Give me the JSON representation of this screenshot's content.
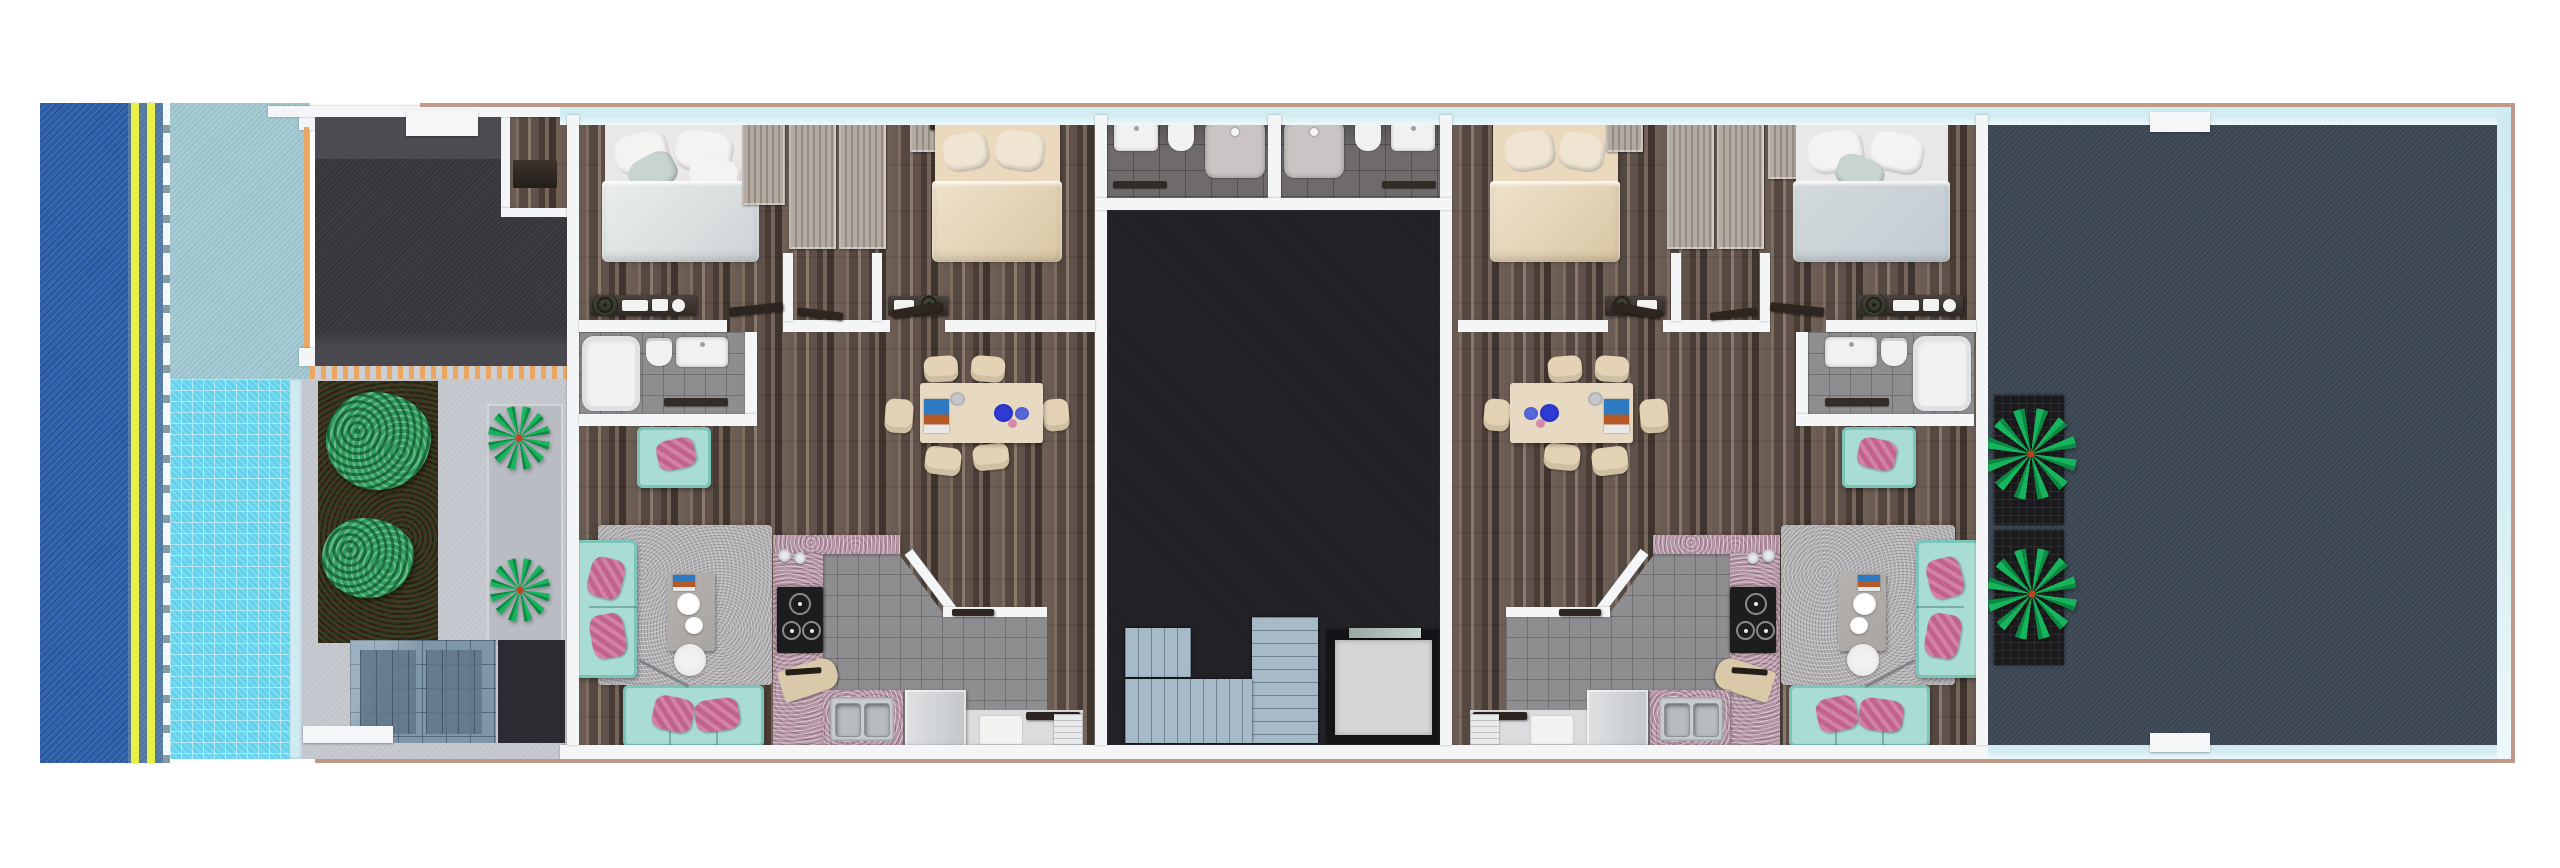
{
  "scene": {
    "kind": "3D rendered architectural floor plan, top-down view",
    "regions": [
      "ocean",
      "beach road with double yellow lane lines",
      "pool deck",
      "swimming pool",
      "dark parking pad with planters and palms",
      "left two-bedroom apartment",
      "central core with two bathrooms, lightwell, staircase and elevator",
      "right two-bedroom apartment (mirrored)",
      "large dark roof terrace with palm planters"
    ]
  },
  "palette": {
    "ocean": "#2e63ae",
    "road_blue": "#5a81ab",
    "lane_yellow": "#e9f04b",
    "curb": "#bcd3da",
    "deck_teal": "#a3c9d3",
    "pool_blue": "#62d2ec",
    "pool_edge": "#cfeaf0",
    "fence_orange": "#eaa763",
    "walkway_gray": "#ccd0d4",
    "pad_dark": "#3a393e",
    "pad_light": "#4c4b51",
    "concrete": "#c7cbd1",
    "mat_gray": "#b9bdc3",
    "soil_brown": "#46351f",
    "bush_green": "#2f9e5b",
    "palm_green": "#16b45c",
    "palm_dark": "#0b8a43",
    "planter_black": "#1b1b1e",
    "skylight_blue": "#7e97a8",
    "skylight_dark": "#5f7789",
    "box_dark": "#2b2b31",
    "wall_white": "#f3f5f6",
    "glass_cyan": "#d6eef3",
    "outline_pink": "#bf9a8b",
    "wood_base": "#63564e",
    "closet_wood": "#b3aaa2",
    "bed_white": "#e9e8e6",
    "bed_cream": "#ead9bd",
    "duvet_blue": "#c3ccd1",
    "headboard": "#352e29",
    "tile_gray": "#8e8d90",
    "smallbath_tile": "#6f6b6d",
    "fixture_white": "#f1f1f2",
    "shower_pan": "#cac5c4",
    "courtyard_black": "#201f24",
    "stair_blue": "#a6bac7",
    "elevator_cab": "#d6d6d8",
    "elevator_frame": "#141417",
    "sofa_teal": "#a9dcd3",
    "sofa_teal_dark": "#7cc3b8",
    "pillow_pink": "#c2638b",
    "pillow_pink2": "#d283a5",
    "rug_gray": "#b7b5b7",
    "table_gray": "#a9a5a3",
    "dining_cream": "#e8dac2",
    "chair_cream": "#e3d2b4",
    "plate_blue": "#2f3bd3",
    "plate_blue2": "#5667d8",
    "counter_mauve": "#b595a5",
    "stove_black": "#1d1d20",
    "steel": "#c9cdd1",
    "terrace_slate": "#3d4955",
    "entry_gray": "#dadcde",
    "door_dark": "#2e2420",
    "lamp_gray": "#e3e3e5"
  }
}
